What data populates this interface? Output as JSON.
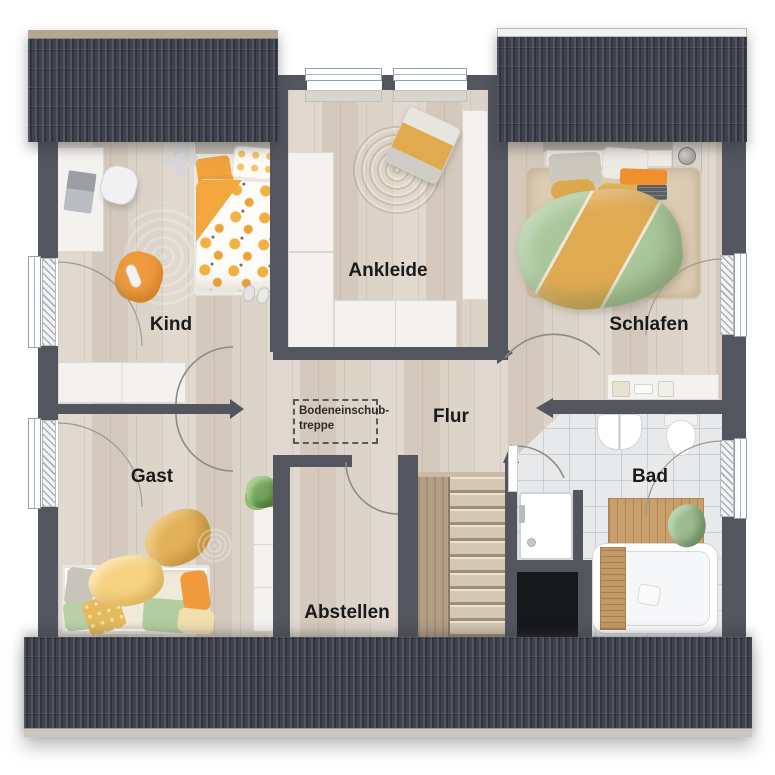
{
  "floorplan": {
    "rooms": {
      "kind": {
        "label": "Kind"
      },
      "ankleide": {
        "label": "Ankleide"
      },
      "schlafen": {
        "label": "Schlafen"
      },
      "flur": {
        "label": "Flur"
      },
      "gast": {
        "label": "Gast"
      },
      "bad": {
        "label": "Bad"
      },
      "abstellen": {
        "label": "Abstellen"
      }
    },
    "annotation": {
      "line1": "Bodeneinschub-",
      "line2": "treppe"
    },
    "colors": {
      "wall": "#53565e",
      "roof": "#3f424d",
      "ridge-tan": "#b3a794",
      "ridge-white": "#f2f2ef",
      "wood": "#dbd2c6",
      "tile": "#e7e9eb",
      "furn": "#f3f2ef",
      "green-rug": "#b7d1a4",
      "jute": "#d8c298",
      "orange": "#ee9a3d",
      "mustard": "#e2b258",
      "duvet-green": "#a9c79b",
      "void": "#17181c",
      "stair-wood": "#d5c7b2",
      "label": "#1a1a1a"
    }
  }
}
